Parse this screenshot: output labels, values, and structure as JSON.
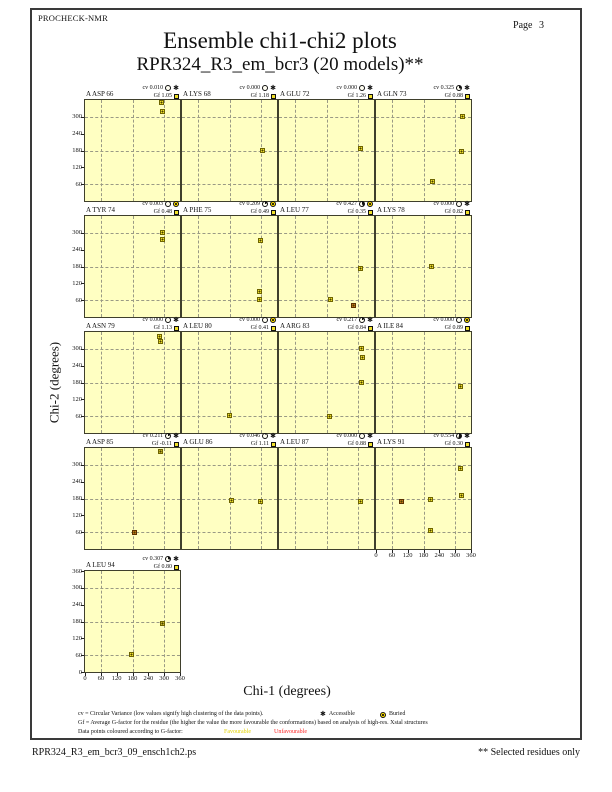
{
  "page": {
    "app_name": "PROCHECK-NMR",
    "page_label": "Page 3",
    "title": "Ensemble chi1-chi2 plots",
    "subtitle": "RPR324_R3_em_bcr3 (20 models)**",
    "ps_filename": "RPR324_R3_em_bcr3_09_ensch1ch2.ps",
    "selected_note": "** Selected residues only"
  },
  "legend": {
    "cv_line": "cv = Circular Variance (low values signify high clustering of the data points).",
    "accessible_label": "Accessible",
    "buried_label": "Buried",
    "gf_line": "Gf = Average G-factor for the residue (the higher the value the more favourable the conformations)  based on analysis of high-res. Xstal structures",
    "colour_line": "Data points coloured according to G-factor:",
    "favourable_label": "Favourable",
    "unfavourable_label": "Unfavourable"
  },
  "colors": {
    "plot_bg": "#ffffc2",
    "grid": "#9a9a85",
    "points": {
      "fav": "#eee02c",
      "unfav": "#c2761d",
      "mid": "#c3b42a"
    },
    "legend_favourable": "#e3d200",
    "legend_unfavourable": "#ff2a2a"
  },
  "chart_data": {
    "type": "scatter",
    "title": "Ensemble chi1-chi2 plots",
    "xlabel": "Chi-1 (degrees)",
    "ylabel": "Chi-2 (degrees)",
    "xlim": [
      0,
      360
    ],
    "ylim": [
      0,
      360
    ],
    "tick_step": 60,
    "gridlines": [
      60,
      180,
      300
    ],
    "x_tick_labels": [
      0,
      60,
      120,
      180,
      240,
      300,
      360
    ],
    "plots": [
      {
        "residue": "A ASP 66",
        "row": 0,
        "col": 0,
        "cv": "0.010",
        "gf": "1.05",
        "env": "accessible",
        "points": [
          [
            290,
            350,
            "fav"
          ],
          [
            297,
            316,
            "fav"
          ]
        ]
      },
      {
        "residue": "A LYS 68",
        "row": 0,
        "col": 1,
        "cv": "0.000",
        "gf": "1.18",
        "env": "accessible",
        "points": [
          [
            308,
            180,
            "fav"
          ]
        ]
      },
      {
        "residue": "A GLU 72",
        "row": 0,
        "col": 2,
        "cv": "0.000",
        "gf": "1.26",
        "env": "accessible",
        "points": [
          [
            312,
            184,
            "fav"
          ]
        ]
      },
      {
        "residue": "A GLN 73",
        "row": 0,
        "col": 3,
        "cv": "0.325",
        "gf": "0.88",
        "env": "accessible",
        "points": [
          [
            329,
            300,
            "fav"
          ],
          [
            327,
            174,
            "fav"
          ],
          [
            215,
            66,
            "fav"
          ]
        ]
      },
      {
        "residue": "A TYR 74",
        "row": 1,
        "col": 0,
        "cv": "0.003",
        "gf": "0.48",
        "env": "buried",
        "points": [
          [
            296,
            298,
            "fav"
          ],
          [
            297,
            273,
            "fav"
          ]
        ]
      },
      {
        "residue": "A PHE 75",
        "row": 1,
        "col": 1,
        "cv": "0.209",
        "gf": "0.49",
        "env": "buried",
        "points": [
          [
            298,
            270,
            "fav"
          ],
          [
            295,
            88,
            "fav"
          ],
          [
            297,
            62,
            "fav"
          ]
        ]
      },
      {
        "residue": "A LEU 77",
        "row": 1,
        "col": 2,
        "cv": "0.427",
        "gf": "0.35",
        "env": "buried",
        "points": [
          [
            311,
            172,
            "fav"
          ],
          [
            196,
            62,
            "fav"
          ],
          [
            283,
            38,
            "unfav"
          ]
        ]
      },
      {
        "residue": "A LYS 78",
        "row": 1,
        "col": 3,
        "cv": "0.000",
        "gf": "0.82",
        "env": "accessible",
        "points": [
          [
            212,
            178,
            "fav"
          ]
        ]
      },
      {
        "residue": "A ASN 79",
        "row": 2,
        "col": 0,
        "cv": "0.000",
        "gf": "1.13",
        "env": "accessible",
        "points": [
          [
            284,
            342,
            "fav"
          ],
          [
            287,
            324,
            "fav"
          ]
        ]
      },
      {
        "residue": "A LEU 80",
        "row": 2,
        "col": 1,
        "cv": "0.000",
        "gf": "0.41",
        "env": "buried",
        "points": [
          [
            181,
            60,
            "fav"
          ]
        ]
      },
      {
        "residue": "A ARG 83",
        "row": 2,
        "col": 2,
        "cv": "0.217",
        "gf": "0.84",
        "env": "accessible",
        "points": [
          [
            315,
            298,
            "fav"
          ],
          [
            318,
            269,
            "fav"
          ],
          [
            315,
            179,
            "fav"
          ],
          [
            194,
            58,
            "fav"
          ]
        ]
      },
      {
        "residue": "A ILE 84",
        "row": 2,
        "col": 3,
        "cv": "0.000",
        "gf": "0.89",
        "env": "buried",
        "points": [
          [
            322,
            164,
            "fav"
          ]
        ]
      },
      {
        "residue": "A ASP 85",
        "row": 3,
        "col": 0,
        "cv": "0.211",
        "gf": "-0.11",
        "env": "accessible",
        "points": [
          [
            287,
            344,
            "mid"
          ],
          [
            190,
            58,
            "unfav"
          ]
        ]
      },
      {
        "residue": "A GLU 86",
        "row": 3,
        "col": 1,
        "cv": "0.046",
        "gf": "1.11",
        "env": "accessible",
        "points": [
          [
            189,
            172,
            "fav"
          ],
          [
            299,
            169,
            "fav"
          ]
        ]
      },
      {
        "residue": "A LEU 87",
        "row": 3,
        "col": 2,
        "cv": "0.000",
        "gf": "0.88",
        "env": "accessible",
        "points": [
          [
            312,
            169,
            "fav"
          ]
        ]
      },
      {
        "residue": "A LYS 91",
        "row": 3,
        "col": 3,
        "cv": "0.554",
        "gf": "0.30",
        "env": "accessible",
        "xlabels": true,
        "points": [
          [
            100,
            169,
            "unfav"
          ],
          [
            209,
            176,
            "fav"
          ],
          [
            209,
            64,
            "fav"
          ],
          [
            322,
            284,
            "fav"
          ],
          [
            326,
            190,
            "fav"
          ]
        ]
      },
      {
        "residue": "A LEU 94",
        "row": 4,
        "col": 0,
        "cv": "0.307",
        "gf": "0.80",
        "env": "accessible",
        "xlabels": true,
        "points": [
          [
            294,
            172,
            "mid"
          ],
          [
            178,
            62,
            "fav"
          ]
        ]
      }
    ]
  }
}
